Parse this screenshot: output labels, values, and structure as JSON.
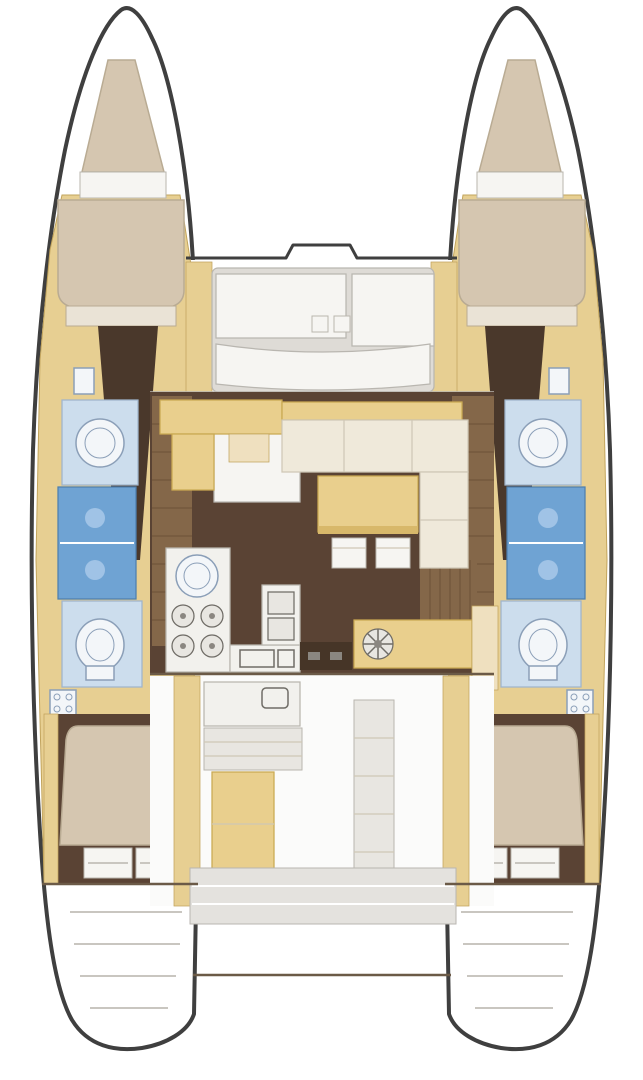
{
  "meta": {
    "title": "Catamaran interior layout floor plan (top view)"
  },
  "colors": {
    "outline": "#3f3f3f",
    "hullFill": "#ffffff",
    "sand": "#e7cf92",
    "sandLine": "#c2a45c",
    "sandLight": "#efe0bf",
    "salonFloor": "#5a4334",
    "woodStairs": "#846749",
    "woodLine": "#6b5138",
    "darkWood": "#463527",
    "headboard": "#4a382b",
    "bedBeige": "#d5c6b0",
    "bedLine": "#b9ab93",
    "pillow": "#eae3d6",
    "cream": "#efe9da",
    "creamLine": "#cfc8b6",
    "tableTan": "#e9cf8d",
    "tableLine": "#c9a952",
    "tableShadow": "#d8b86a",
    "bathBlue": "#ccdded",
    "bathLine": "#9fb4cc",
    "showerBlue": "#6fa3d3",
    "showerLine": "#4d7fae",
    "showerGlow": "#a9c9e9",
    "fixtureWhite": "#f3f6f9",
    "fixtureLine": "#8b9fb8",
    "counterWhite": "#f2f1ed",
    "counterLine": "#b9b6ae",
    "applianceLine": "#6f6c66",
    "deckGray": "#dedbd6",
    "deckLine": "#b9b6b0",
    "panelWhite": "#f6f5f2",
    "floorWhite": "#fbfbfa",
    "benchGray": "#e8e6e1",
    "platformGray": "#e4e2de",
    "stepLine": "#c9c6c0",
    "wallLine": "#6b5a47",
    "handleGray": "#8a8680"
  },
  "areas": {
    "portHull": "Port hull",
    "starboardHull": "Starboard hull",
    "foredeck": "Forward cockpit seating",
    "salon": "Salon and dinette",
    "galley": "Galley",
    "navStation": "Nav station cabinet",
    "aftCockpit": "Aft cockpit",
    "aftPlatform": "Aft platform",
    "portForwardCabin": "Port forward cabin",
    "portBathroom": "Port bathroom and shower",
    "portAftCabin": "Port aft cabin",
    "starboardForwardCabin": "Starboard forward cabin",
    "starboardBathroom": "Starboard bathroom and shower",
    "starboardAftCabin": "Starboard aft cabin"
  }
}
